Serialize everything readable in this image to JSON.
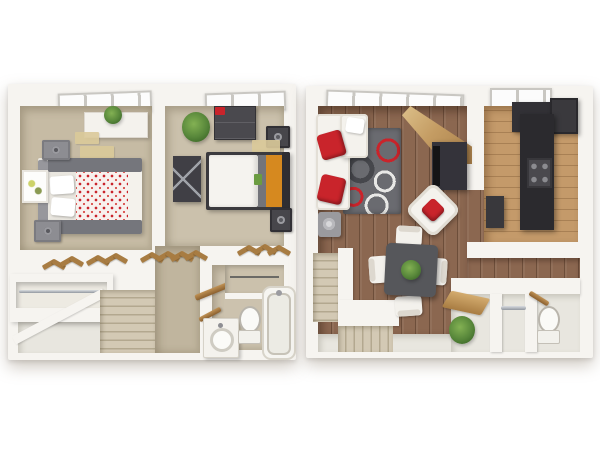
{
  "image": {
    "kind": "3d-floor-plan-rendering",
    "view": "top-down dollhouse",
    "panel_count": 2,
    "panels": [
      "upper-floor",
      "main-floor"
    ]
  },
  "upper_floor": {
    "name": "upper-floor-plan",
    "rooms": [
      {
        "name": "bedroom-1",
        "furniture": [
          "double-bed-polka-dot-comforter",
          "white-dresser",
          "potted-plant",
          "two-speakers",
          "wall-art",
          "beige-rugs",
          "window"
        ]
      },
      {
        "name": "bedroom-2",
        "furniture": [
          "double-bed-orange-trim",
          "dark-dresser",
          "media-console",
          "potted-plant",
          "two-speakers",
          "beige-rug",
          "window"
        ]
      },
      {
        "name": "hallway",
        "furniture": [
          "wooden-clothes-hangers"
        ]
      },
      {
        "name": "closet",
        "furniture": [
          "hanging-rod",
          "wooden-clothes-hangers"
        ]
      },
      {
        "name": "bathroom",
        "furniture": [
          "vanity-sink",
          "toilet",
          "bathtub",
          "linen-closet-with-rod"
        ]
      },
      {
        "name": "staircase",
        "furniture": []
      }
    ]
  },
  "main_floor": {
    "name": "main-floor-plan",
    "rooms": [
      {
        "name": "living-room",
        "furniture": [
          "white-sectional-sofa",
          "red-throw-pillows",
          "swirl-area-rug",
          "tv-console",
          "white-accent-chair-red-cushion",
          "gray-side-table",
          "windows",
          "angled-wood-entry"
        ]
      },
      {
        "name": "kitchen",
        "furniture": [
          "refrigerator",
          "range-stove",
          "dark-cabinets",
          "window"
        ]
      },
      {
        "name": "dining-area",
        "furniture": [
          "dark-square-table",
          "four-white-chairs",
          "centerpiece-plant"
        ]
      },
      {
        "name": "entry",
        "furniture": [
          "console-desk",
          "wood-shelf",
          "potted-shrub"
        ]
      },
      {
        "name": "closet",
        "furniture": [
          "hanging-rod"
        ]
      },
      {
        "name": "half-bath",
        "furniture": [
          "toilet",
          "wooden-hangers"
        ]
      },
      {
        "name": "staircase",
        "furniture": []
      }
    ]
  },
  "colors": {
    "bg": "#ffffff",
    "wall": "#f6f4f0",
    "wall-shade": "#e6e2da",
    "carpet-1": "#c6bba4",
    "carpet-2": "#cbc1ac",
    "carpet-hall": "#c0b59e",
    "bath-floor": "#ccc2ae",
    "landing": "#e8e6df",
    "stair": "#d3c9b4",
    "stair-line": "#b3a88f",
    "wood": "#8b6750",
    "wood-light": "#c49a6a",
    "red": "#c9242b",
    "orange": "#d6891f",
    "green": "#5e8c3a",
    "hanger": "#a87c42",
    "pane": "#fcfcfc",
    "mullion": "#c9c7c2",
    "rug-base": "#6a6b70",
    "rug-light": "#e8e8e6",
    "rug-dark": "#46474c",
    "dark-furn": "#403f44",
    "gray-furn": "#8d8d92",
    "chrome": "#b7babf",
    "tan-mat": "#dbca9a",
    "white-furn": "#f4f2ed"
  }
}
